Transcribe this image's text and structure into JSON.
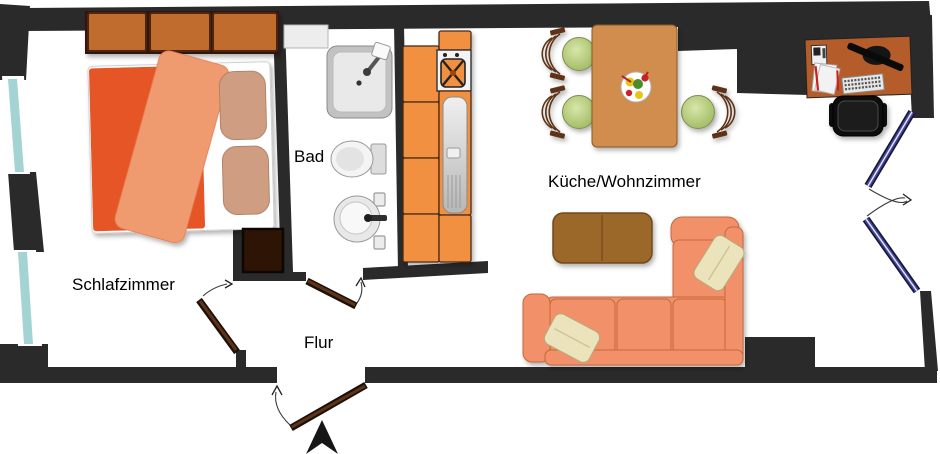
{
  "plan_title": "Apartment floor plan",
  "rooms": {
    "bedroom": {
      "label": "Schlafzimmer"
    },
    "bathroom": {
      "label": "Bad"
    },
    "hallway": {
      "label": "Flur"
    },
    "kitchen_living": {
      "label": "Küche/Wohnzimmer"
    }
  },
  "icons": {
    "bedroom": [
      "wardrobe-icon",
      "double-bed-icon",
      "pillow-icon",
      "dresser-icon"
    ],
    "bathroom": [
      "radiator-icon",
      "shower-icon",
      "toilet-icon",
      "washbasin-icon"
    ],
    "kitchen": [
      "cabinet-icon",
      "stove-icon",
      "kitchen-sink-icon"
    ],
    "living": [
      "dining-table-icon",
      "chair-icon",
      "flower-vase-icon",
      "sofa-icon",
      "cushion-icon",
      "coffee-table-icon",
      "desk-icon",
      "monitor-icon",
      "keyboard-icon",
      "papers-icon",
      "phone-icon",
      "office-chair-icon"
    ],
    "openings": [
      "door-icon",
      "entrance-door-icon",
      "balcony-double-door-icon",
      "window-icon",
      "north-arrow-icon"
    ]
  },
  "colors": {
    "wall": "#2a2a2a",
    "window_glass": "#a3d4d3",
    "door_wood": "#5e3317",
    "door_dark": "#1c1008",
    "balcony_blue": "#4449a8",
    "bed_duvet": "#e65427",
    "bed_blanket": "#f09a70",
    "bed_pillow": "#cf9e82",
    "wardrobe": "#bf6c2f",
    "dresser": "#2d1404",
    "kitchen_orange": "#f19040",
    "table_wood": "#d08d4e",
    "chair_green": "#b6cd7d",
    "chair_frame": "#5d3113",
    "sofa": "#f29069",
    "sofa_pillow": "#ebe3bb",
    "coffee_table": "#9c672a",
    "desk": "#b45d2b"
  }
}
